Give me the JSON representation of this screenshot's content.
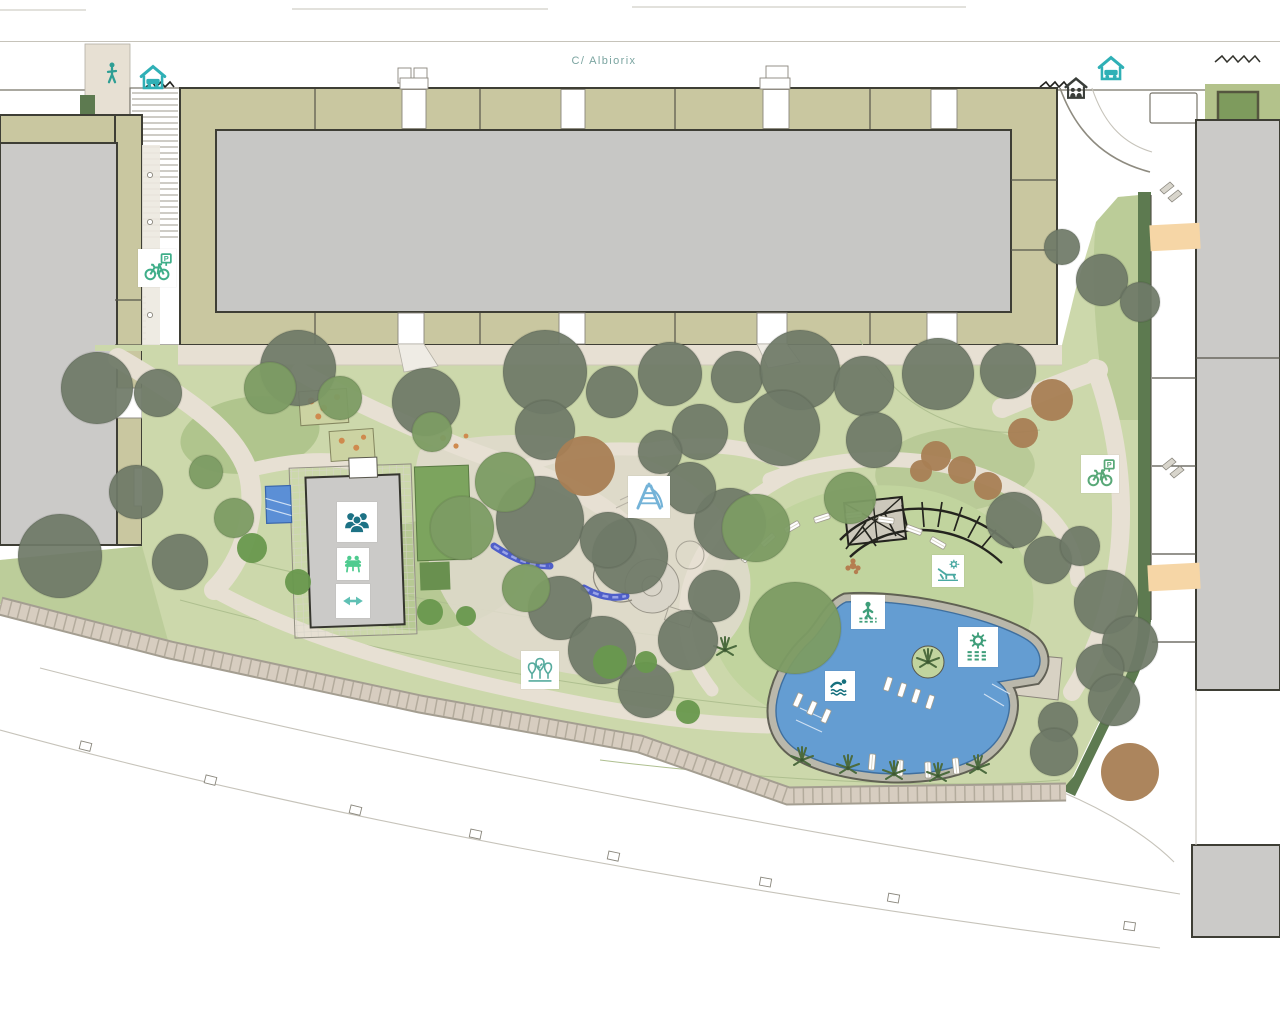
{
  "street": {
    "label": "C/ Albiorix"
  },
  "colors": {
    "building-olive": "#c9c7a0",
    "courtyard-gray": "#c7c7c5",
    "building-gray": "#cbcac8",
    "lawn-green": "#ccd8ab",
    "lawn-dark": "#a9c086",
    "hedge-green": "#5d7a50",
    "tree-dark": "#6f7a68",
    "tree-green": "#7d9c64",
    "tree-brown": "#a87e54",
    "path-beige": "#e7e0d3",
    "sidewalk-tan": "#d7cdc0",
    "pool-blue": "#649dd2",
    "crossing-peach": "#f6d6a6",
    "street-label": "#7aa4a0",
    "accent-teal": "#2e9e94",
    "icon-dark-teal": "#1d7285",
    "icon-mint": "#4ecb8f",
    "icon-blue": "#74b3d8",
    "icon-green": "#44a27c"
  },
  "markers": [
    {
      "id": "pedestrian-entrance-icon",
      "icon": "pedestrian",
      "x": 112,
      "y": 73,
      "size": 26,
      "color": "#2e9e94",
      "boxed": false
    },
    {
      "id": "car-park-entrance-west-icon",
      "icon": "house-car",
      "x": 153,
      "y": 77,
      "size": 32,
      "color": "#2fb0b6",
      "boxed": false
    },
    {
      "id": "car-park-entrance-east-icon",
      "icon": "house-car",
      "x": 1111,
      "y": 68,
      "size": 32,
      "color": "#2fb0b6",
      "boxed": false
    },
    {
      "id": "residential-entrance-east-icon",
      "icon": "house-people",
      "x": 1076,
      "y": 88,
      "size": 28,
      "color": "#3a3e3a",
      "boxed": false
    },
    {
      "id": "bike-parking-west-icon",
      "icon": "bike-parking",
      "x": 157,
      "y": 268,
      "size": 38,
      "color": "#3fae89",
      "boxed": true
    },
    {
      "id": "bike-parking-east-icon",
      "icon": "bike-parking",
      "x": 1100,
      "y": 474,
      "size": 38,
      "color": "#58a877",
      "boxed": true
    },
    {
      "id": "community-room-icon",
      "icon": "community",
      "x": 357,
      "y": 522,
      "size": 40,
      "color": "#1d7285",
      "boxed": true
    },
    {
      "id": "social-room-icon",
      "icon": "social",
      "x": 353,
      "y": 564,
      "size": 32,
      "color": "#4ecb8f",
      "boxed": true
    },
    {
      "id": "gym-icon",
      "icon": "dumbbell",
      "x": 353,
      "y": 601,
      "size": 34,
      "color": "#5fc0b4",
      "boxed": true
    },
    {
      "id": "playground-icon",
      "icon": "playground",
      "x": 649,
      "y": 497,
      "size": 42,
      "color": "#74b3d8",
      "boxed": true
    },
    {
      "id": "garden-trees-icon",
      "icon": "trees",
      "x": 540,
      "y": 670,
      "size": 38,
      "color": "#57ab9e",
      "boxed": true
    },
    {
      "id": "wading-pool-icon",
      "icon": "wading",
      "x": 868,
      "y": 612,
      "size": 34,
      "color": "#3f9e7a",
      "boxed": true
    },
    {
      "id": "sun-deck-icon",
      "icon": "sun-waves",
      "x": 978,
      "y": 647,
      "size": 40,
      "color": "#3f9e7a",
      "boxed": true
    },
    {
      "id": "swimming-pool-icon",
      "icon": "swimmer",
      "x": 840,
      "y": 686,
      "size": 30,
      "color": "#156f7d",
      "boxed": true
    },
    {
      "id": "sun-loungers-icon",
      "icon": "lounger",
      "x": 948,
      "y": 571,
      "size": 32,
      "color": "#4aa9a2",
      "boxed": true
    }
  ]
}
